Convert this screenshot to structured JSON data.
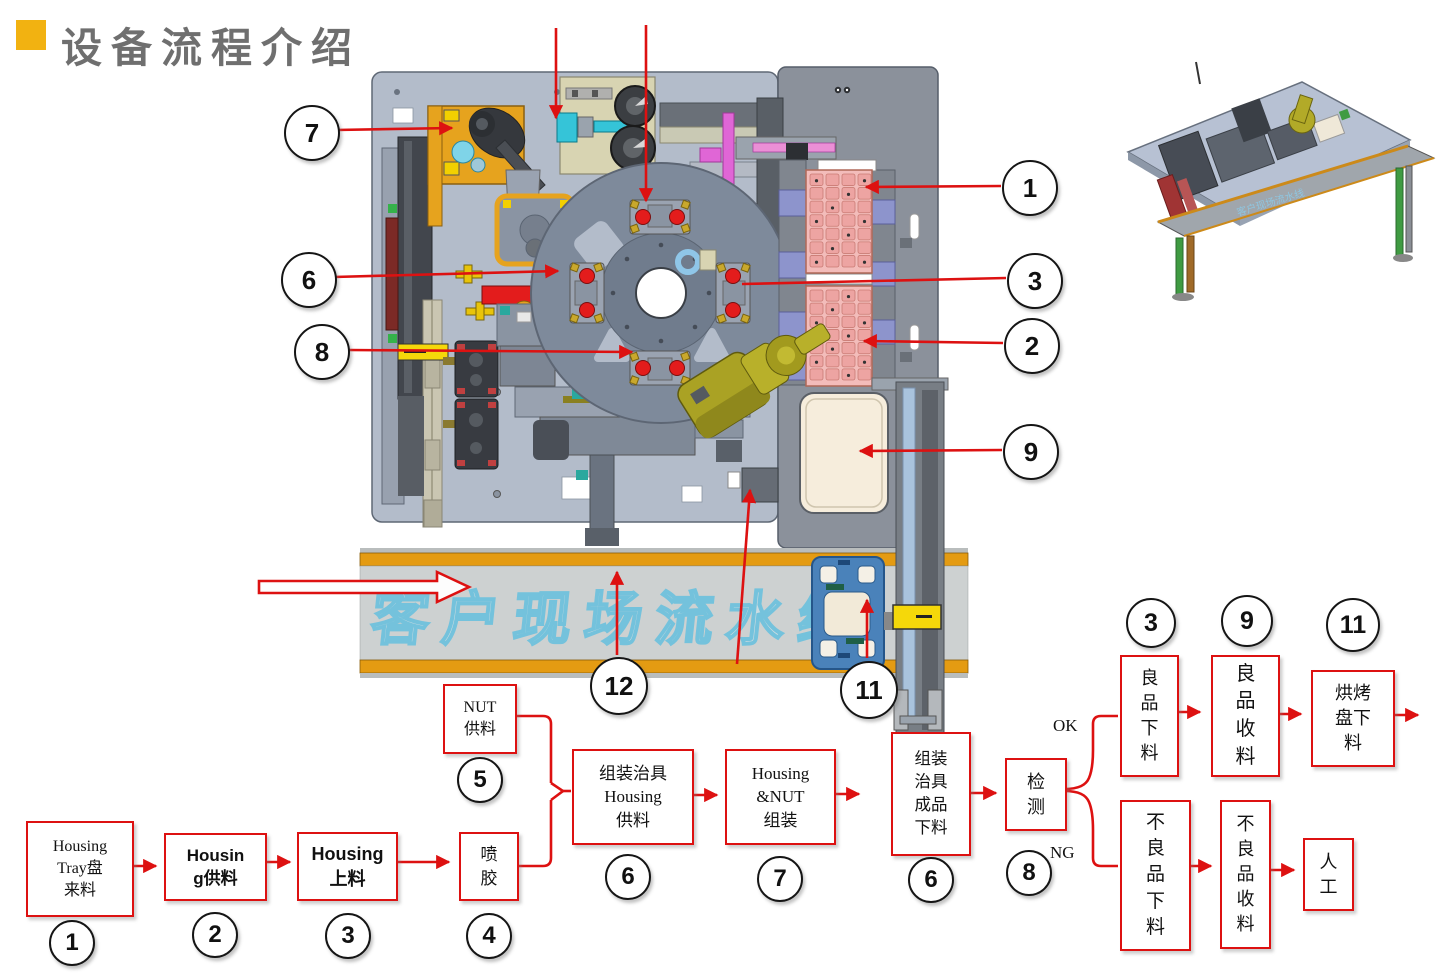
{
  "slide": {
    "title": "设备流程介绍",
    "accent_color": "#F2B211",
    "callout_color": "#DD1111"
  },
  "machine": {
    "conveyor_label": "客户现场流水线"
  },
  "callouts": [
    {
      "n": "7"
    },
    {
      "n": "6"
    },
    {
      "n": "8"
    },
    {
      "n": "1"
    },
    {
      "n": "3"
    },
    {
      "n": "2"
    },
    {
      "n": "9"
    },
    {
      "n": "12"
    },
    {
      "n": "11"
    }
  ],
  "flow": {
    "ok_label": "OK",
    "ng_label": "NG",
    "boxes": [
      {
        "label": "Housing\nTray盘\n来料",
        "num": "1"
      },
      {
        "label": "Housin\ng供料",
        "num": "2"
      },
      {
        "label": "Housing\n上料",
        "num": "3"
      },
      {
        "label": "喷胶",
        "num": "4"
      },
      {
        "label": "NUT\n供料",
        "num": "5"
      },
      {
        "label": "组装治具\nHousing\n供料",
        "num": "6"
      },
      {
        "label": "Housing\n&NUT\n组装",
        "num": "7"
      },
      {
        "label": "组装治具成品下料",
        "num": "6"
      },
      {
        "label": "检测",
        "num": "8"
      },
      {
        "label": "良品下料",
        "num": "3"
      },
      {
        "label": "良品收料",
        "num": "9"
      },
      {
        "label": "烘烤盘下料",
        "num": "11"
      },
      {
        "label": "不良品下料"
      },
      {
        "label": "不良品收料"
      },
      {
        "label": "人工"
      }
    ]
  }
}
